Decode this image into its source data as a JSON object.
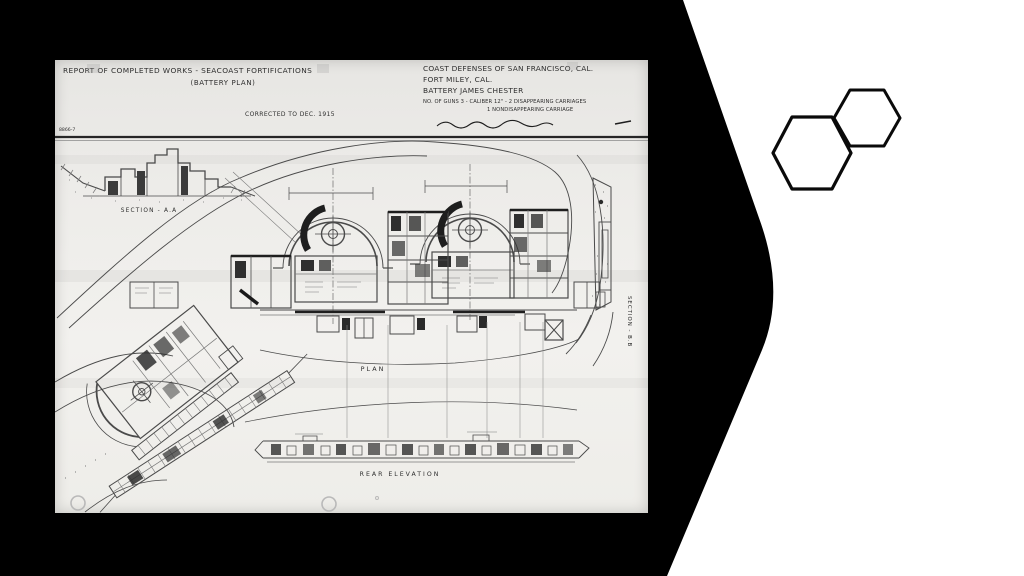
{
  "slide": {
    "background_color": "#ffffff",
    "chevron_color": "#000000",
    "hexagon_outline_color": "#0a0a0a"
  },
  "drawing": {
    "paper_color": "#edecea",
    "ink_color": "#3a3a3a",
    "header": {
      "title_line1": "REPORT OF COMPLETED WORKS - SEACOAST FORTIFICATIONS",
      "title_line2": "(BATTERY PLAN)",
      "corrected_note": "CORRECTED TO DEC. 1915",
      "defense_line1": "COAST DEFENSES OF SAN FRANCISCO, CAL.",
      "defense_line2": "FORT MILEY, CAL.",
      "defense_line3": "BATTERY JAMES CHESTER",
      "armament_line1": "NO. OF GUNS 3 - CALIBER 12\" - 2 DISAPPEARING CARRIAGES",
      "armament_line2": "1 NONDISAPPEARING CARRIAGE",
      "sheet_number": "8866-7"
    },
    "labels": {
      "section_aa": "SECTION - A.A",
      "section_bb": "SECTION - B.B",
      "plan": "PLAN",
      "rear_elevation": "REAR ELEVATION"
    }
  }
}
